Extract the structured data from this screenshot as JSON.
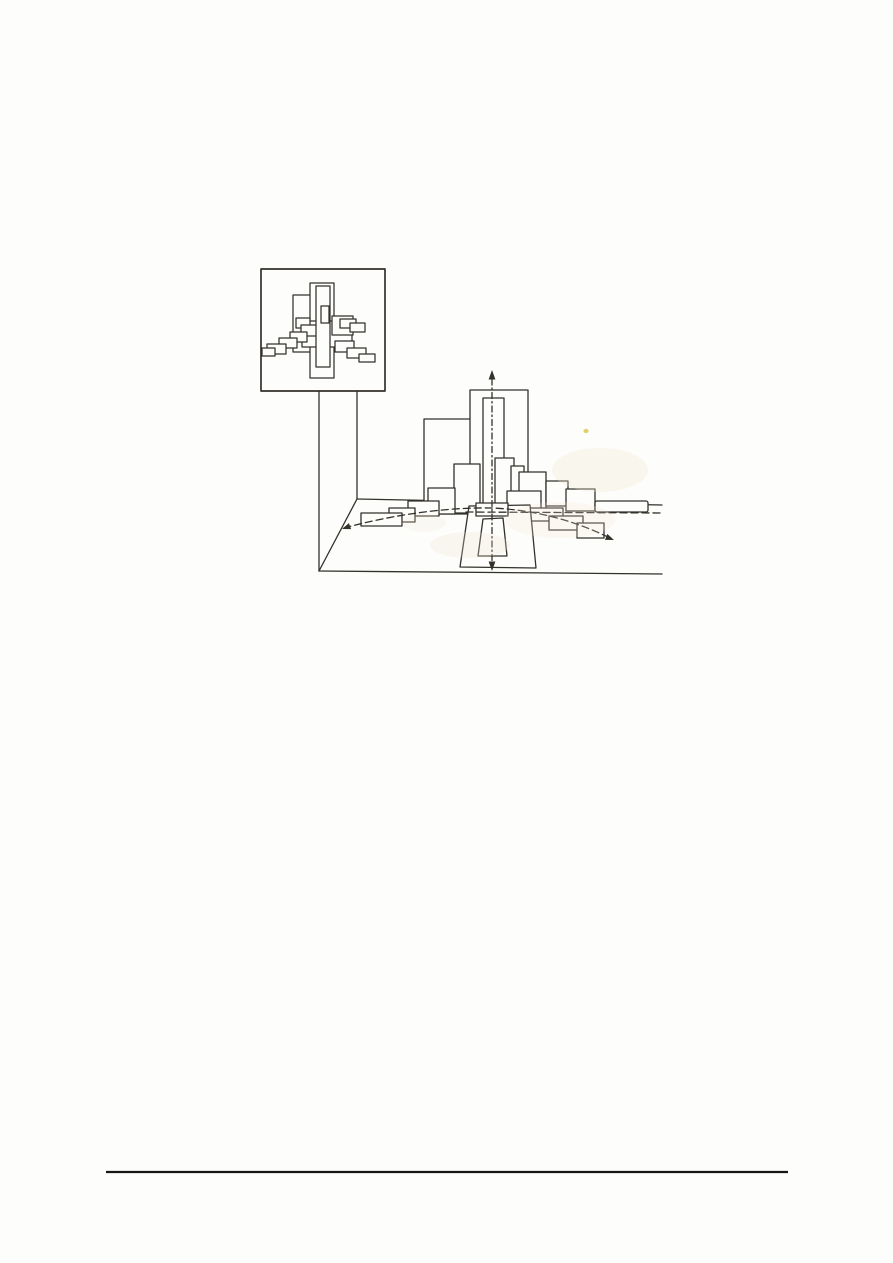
{
  "meta": {
    "description": "Scanned book page: figure showing a framed abstract painting of overlapping rectangles and a perspective drawing of the same rectangles staggered in pictorial depth",
    "visible_text": ""
  },
  "colors": {
    "paper": "#fdfdfc",
    "ink": "#34312b",
    "rule": "#161616",
    "stain": "#f3e7cd",
    "speck": "#d8cb4e"
  },
  "figure": {
    "perspective": {
      "defaults": {
        "stroke": "#34312b",
        "stroke-width": 1.3,
        "fill": "none",
        "stroke-linecap": "round",
        "stroke-linejoin": "round"
      },
      "shapes": [
        {
          "tag": "line",
          "name": "stand-left-leg",
          "x1": 319,
          "y1": 391,
          "x2": 319,
          "y2": 571
        },
        {
          "tag": "line",
          "name": "stand-right-leg",
          "x1": 357,
          "y1": 391,
          "x2": 357,
          "y2": 499
        },
        {
          "tag": "line",
          "name": "floor-left-edge",
          "x1": 357,
          "y1": 499,
          "x2": 319,
          "y2": 571
        },
        {
          "tag": "line",
          "name": "floor-back-edge",
          "x1": 357,
          "y1": 499,
          "x2": 662,
          "y2": 505
        },
        {
          "tag": "line",
          "name": "floor-front-edge",
          "x1": 319,
          "y1": 571,
          "x2": 662,
          "y2": 574
        },
        {
          "tag": "rect",
          "name": "depth-plane-left-large",
          "x": 424,
          "y": 419,
          "width": 47,
          "height": 95,
          "fill": "#fdfdfc"
        },
        {
          "tag": "rect",
          "name": "tower-outer-plane",
          "x": 470,
          "y": 390,
          "width": 58,
          "height": 119,
          "fill": "#fdfdfc"
        },
        {
          "tag": "rect",
          "name": "tower-inner-plane",
          "x": 483,
          "y": 398,
          "width": 21,
          "height": 108,
          "fill": "#fdfdfc"
        },
        {
          "tag": "rect",
          "name": "depth-plane-left",
          "x": 454,
          "y": 464,
          "width": 26,
          "height": 49,
          "fill": "#fdfdfc"
        },
        {
          "tag": "rect",
          "name": "depth-plane-left",
          "x": 428,
          "y": 488,
          "width": 27,
          "height": 26,
          "fill": "#fdfdfc"
        },
        {
          "tag": "rect",
          "name": "depth-plane-left",
          "x": 408,
          "y": 501,
          "width": 31,
          "height": 15,
          "fill": "#fdfdfc"
        },
        {
          "tag": "rect",
          "name": "depth-plane-left",
          "x": 389,
          "y": 508,
          "width": 26,
          "height": 14,
          "fill": "#fdfdfc"
        },
        {
          "tag": "rect",
          "name": "depth-plane-left",
          "x": 361,
          "y": 513,
          "width": 41,
          "height": 13,
          "fill": "#fdfdfc"
        },
        {
          "tag": "rect",
          "name": "depth-plane-right",
          "x": 495,
          "y": 458,
          "width": 19,
          "height": 46,
          "fill": "#fdfdfc"
        },
        {
          "tag": "rect",
          "name": "depth-plane-right",
          "x": 511,
          "y": 466,
          "width": 13,
          "height": 46,
          "fill": "#fdfdfc"
        },
        {
          "tag": "rect",
          "name": "depth-plane-right",
          "x": 519,
          "y": 472,
          "width": 27,
          "height": 38,
          "fill": "#fdfdfc"
        },
        {
          "tag": "rect",
          "name": "depth-plane-right",
          "x": 546,
          "y": 481,
          "width": 22,
          "height": 25,
          "fill": "#fdfdfc"
        },
        {
          "tag": "rect",
          "name": "depth-plane-right",
          "x": 566,
          "y": 489,
          "width": 29,
          "height": 22,
          "fill": "#fdfdfc"
        },
        {
          "tag": "rect",
          "name": "depth-plane-right-bar",
          "x": 595,
          "y": 501,
          "width": 53,
          "height": 11,
          "rx": 2,
          "fill": "#fdfdfc"
        },
        {
          "tag": "rect",
          "name": "front-plane-right",
          "x": 507,
          "y": 491,
          "width": 34,
          "height": 26,
          "fill": "#fdfdfc"
        },
        {
          "tag": "rect",
          "name": "front-plane-right",
          "x": 528,
          "y": 508,
          "width": 35,
          "height": 13,
          "fill": "#fdfdfc"
        },
        {
          "tag": "rect",
          "name": "front-plane-right",
          "x": 549,
          "y": 516,
          "width": 34,
          "height": 14,
          "fill": "#fdfdfc"
        },
        {
          "tag": "rect",
          "name": "front-plane-right",
          "x": 577,
          "y": 523,
          "width": 27,
          "height": 15,
          "fill": "#fdfdfc"
        },
        {
          "tag": "polygon",
          "name": "pedestal-outer",
          "points": "469,506 530,505 536,568 460,567",
          "fill": "#fdfdfc"
        },
        {
          "tag": "polygon",
          "name": "pedestal-inner",
          "points": "483,519 503,518 507,556 478,556",
          "fill": "#fdfdfc"
        },
        {
          "tag": "rect",
          "name": "axis-cross-bar",
          "x": 476,
          "y": 503,
          "width": 32,
          "height": 13,
          "fill": "#fdfdfc"
        },
        {
          "tag": "line",
          "name": "picture-plane-dashed-line",
          "x1": 466,
          "y1": 512,
          "x2": 663,
          "y2": 513,
          "stroke-dasharray": "7,4"
        },
        {
          "tag": "path",
          "name": "viewing-path-dashed-curve",
          "d": "M 344 528 C 392 515 446 507 492 508 C 540 510 580 523 612 539",
          "stroke-dasharray": "7,4"
        },
        {
          "tag": "line",
          "name": "central-axis-dashdot",
          "x1": 492,
          "y1": 379,
          "x2": 492,
          "y2": 562,
          "stroke-dasharray": "6,3,1.5,3"
        },
        {
          "tag": "polygon",
          "name": "axis-arrow-up",
          "points": "492,370 488.6,379.5 495.4,379.5",
          "fill": "#34312b",
          "stroke": "none"
        },
        {
          "tag": "polygon",
          "name": "axis-arrow-down",
          "points": "492,571 488.6,561.5 495.4,561.5",
          "fill": "#34312b",
          "stroke": "none"
        },
        {
          "tag": "polygon",
          "name": "path-arrow-left",
          "points": "342,529 348.9,523.1 351.1,529.1",
          "fill": "#34312b",
          "stroke": "none"
        },
        {
          "tag": "polygon",
          "name": "path-arrow-right",
          "points": "614,540 605,539.9 607.3,533.9",
          "fill": "#34312b",
          "stroke": "none"
        }
      ]
    },
    "inset": {
      "defaults": {
        "stroke": "#34312b",
        "stroke-width": 1.25,
        "fill": "#fdfdfc",
        "stroke-linejoin": "round"
      },
      "shapes": [
        {
          "tag": "rect",
          "name": "picture-frame",
          "x": 261,
          "y": 269,
          "width": 124,
          "height": 122,
          "fill": "none",
          "stroke-width": 1.7
        },
        {
          "tag": "rect",
          "name": "inset-large-rect",
          "x": 293,
          "y": 295,
          "width": 39,
          "height": 57
        },
        {
          "tag": "rect",
          "name": "inset-tall-back-rect",
          "x": 310,
          "y": 283,
          "width": 24,
          "height": 95
        },
        {
          "tag": "rect",
          "name": "inset-mid-wide-rect",
          "x": 302,
          "y": 321,
          "width": 50,
          "height": 26
        },
        {
          "tag": "rect",
          "name": "inset-right-mid-rect",
          "x": 332,
          "y": 316,
          "width": 21,
          "height": 19
        },
        {
          "tag": "rect",
          "name": "inset-step-right-upper",
          "x": 340,
          "y": 319,
          "width": 16,
          "height": 9
        },
        {
          "tag": "rect",
          "name": "inset-step-right-upper",
          "x": 350,
          "y": 323,
          "width": 15,
          "height": 9
        },
        {
          "tag": "rect",
          "name": "inset-step-left",
          "x": 296,
          "y": 318,
          "width": 14,
          "height": 10
        },
        {
          "tag": "rect",
          "name": "inset-step-left",
          "x": 301,
          "y": 325,
          "width": 16,
          "height": 11
        },
        {
          "tag": "rect",
          "name": "inset-step-left",
          "x": 290,
          "y": 332,
          "width": 17,
          "height": 10
        },
        {
          "tag": "rect",
          "name": "inset-step-left",
          "x": 279,
          "y": 338,
          "width": 18,
          "height": 10
        },
        {
          "tag": "rect",
          "name": "inset-step-left",
          "x": 267,
          "y": 344,
          "width": 19,
          "height": 10
        },
        {
          "tag": "rect",
          "name": "inset-step-left",
          "x": 262,
          "y": 348,
          "width": 13,
          "height": 8
        },
        {
          "tag": "rect",
          "name": "inset-step-right-lower",
          "x": 335,
          "y": 341,
          "width": 19,
          "height": 11
        },
        {
          "tag": "rect",
          "name": "inset-step-right-lower",
          "x": 347,
          "y": 348,
          "width": 19,
          "height": 10
        },
        {
          "tag": "rect",
          "name": "inset-step-right-lower",
          "x": 359,
          "y": 354,
          "width": 16,
          "height": 8
        },
        {
          "tag": "rect",
          "name": "inset-central-bar",
          "x": 316,
          "y": 286,
          "width": 14,
          "height": 81
        },
        {
          "tag": "rect",
          "name": "inset-central-inner-bar",
          "x": 321,
          "y": 306,
          "width": 8,
          "height": 17
        }
      ]
    },
    "artifacts": {
      "defaults": {
        "stroke": "none"
      },
      "shapes": [
        {
          "tag": "ellipse",
          "name": "scan-stain",
          "cx": 600,
          "cy": 470,
          "rx": 48,
          "ry": 22,
          "fill": "#f3e7cd",
          "opacity": 0.3
        },
        {
          "tag": "ellipse",
          "name": "scan-stain",
          "cx": 560,
          "cy": 520,
          "rx": 55,
          "ry": 18,
          "fill": "#f3e7cd",
          "opacity": 0.22
        },
        {
          "tag": "ellipse",
          "name": "scan-stain",
          "cx": 470,
          "cy": 545,
          "rx": 40,
          "ry": 13,
          "fill": "#f1e5cc",
          "opacity": 0.25
        },
        {
          "tag": "ellipse",
          "name": "scan-stain",
          "cx": 424,
          "cy": 523,
          "rx": 22,
          "ry": 9,
          "fill": "#f3e8d2",
          "opacity": 0.22
        },
        {
          "tag": "ellipse",
          "name": "scan-speck",
          "cx": 586,
          "cy": 431,
          "rx": 2.6,
          "ry": 2.1,
          "fill": "#d8cb4e",
          "opacity": 0.85
        }
      ]
    }
  },
  "footer": {
    "defaults": {
      "stroke": "#161616",
      "stroke-width": 2.3
    },
    "shapes": [
      {
        "tag": "line",
        "name": "footer-rule",
        "x1": 106,
        "y1": 1172,
        "x2": 788,
        "y2": 1172
      }
    ]
  }
}
